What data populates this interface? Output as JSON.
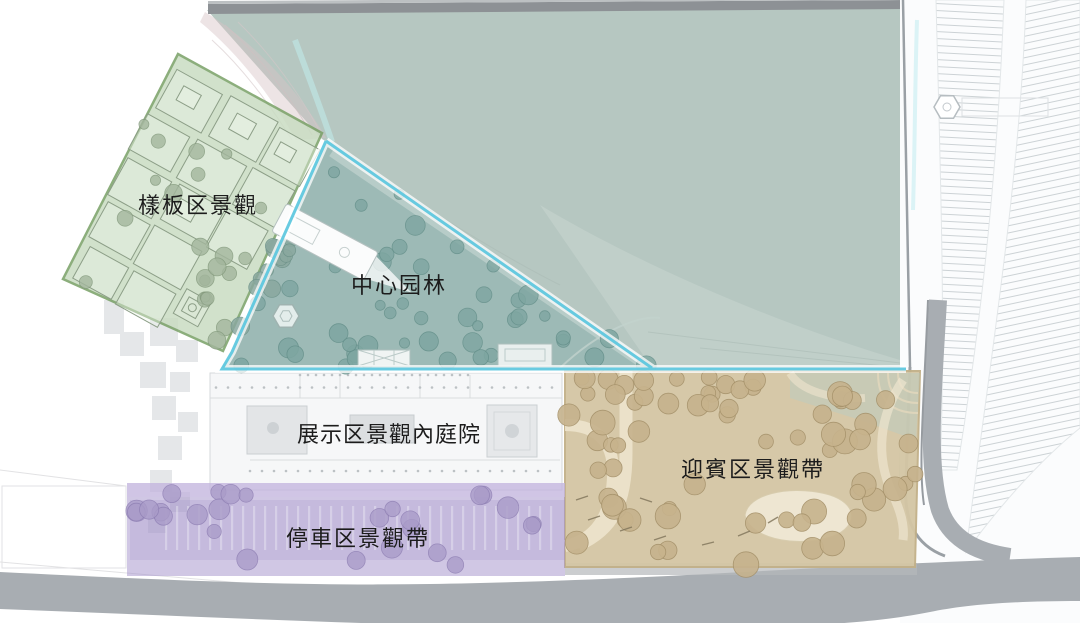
{
  "zones": {
    "model_area": {
      "label": "樣板区景觀",
      "fill": "#c9dcc2",
      "border": "#78a066"
    },
    "central_garden": {
      "label": "中心园林",
      "fill": "#8fb0ac",
      "border": "#58c5de"
    },
    "exhibition_courtyard": {
      "label": "展示区景觀內庭院",
      "fill": "#f6f7f8",
      "border": "#d6d9db"
    },
    "welcome_belt": {
      "label": "迎賓区景觀帶",
      "fill": "#d4c6a4",
      "border": "#c2b088"
    },
    "parking_belt": {
      "label": "停車区景觀帶",
      "fill": "#a493cb",
      "border": "#9c8cc0"
    }
  },
  "base": {
    "background": "#ffffff",
    "water": "#b6c7c1",
    "road": "#a8adb2",
    "top_road": "#8d9195",
    "label_color": "#1c1c1c",
    "highlight_cyan": "#58c5de"
  }
}
